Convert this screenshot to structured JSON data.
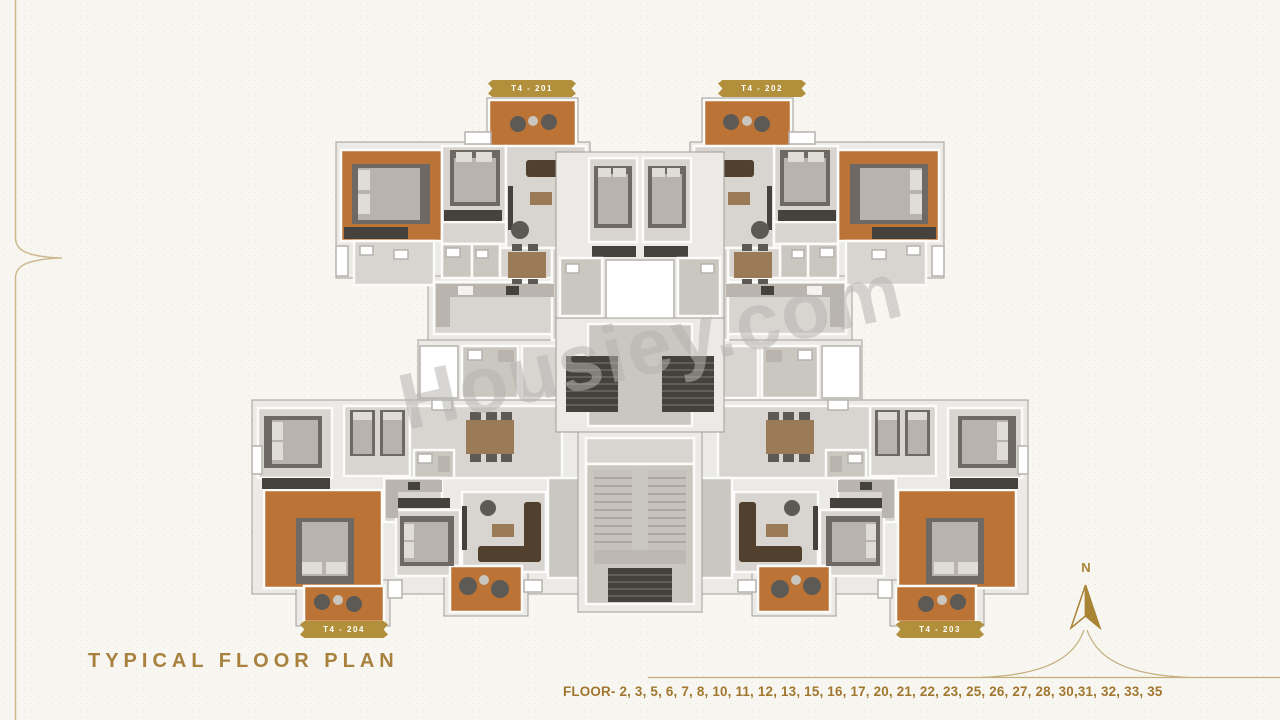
{
  "watermark": {
    "text": "Housiey.com"
  },
  "floor_plan": {
    "type": "residential-tower-typical-floor-plan",
    "units": [
      {
        "id": "T4-201",
        "label": "T4 - 201",
        "position": "top-left"
      },
      {
        "id": "T4-202",
        "label": "T4 - 202",
        "position": "top-right"
      },
      {
        "id": "T4-204",
        "label": "T4 - 204",
        "position": "bottom-left"
      },
      {
        "id": "T4-203",
        "label": "T4 - 203",
        "position": "bottom-right"
      }
    ],
    "colors": {
      "balcony_deck": "#bc7336",
      "room_floor": "#d8d5d0",
      "walls": "#eceae6",
      "core_shaft": "#45413c",
      "background": "#f8f6f1",
      "accent_gold": "#a8813e"
    }
  },
  "compass": {
    "north_label": "N"
  },
  "footer": {
    "title": "TYPICAL FLOOR PLAN",
    "floors": "FLOOR- 2, 3, 5, 6, 7, 8, 10, 11, 12, 13, 15, 16, 17, 20, 21, 22, 23, 25, 26, 27, 28, 30,31, 32, 33, 35"
  }
}
